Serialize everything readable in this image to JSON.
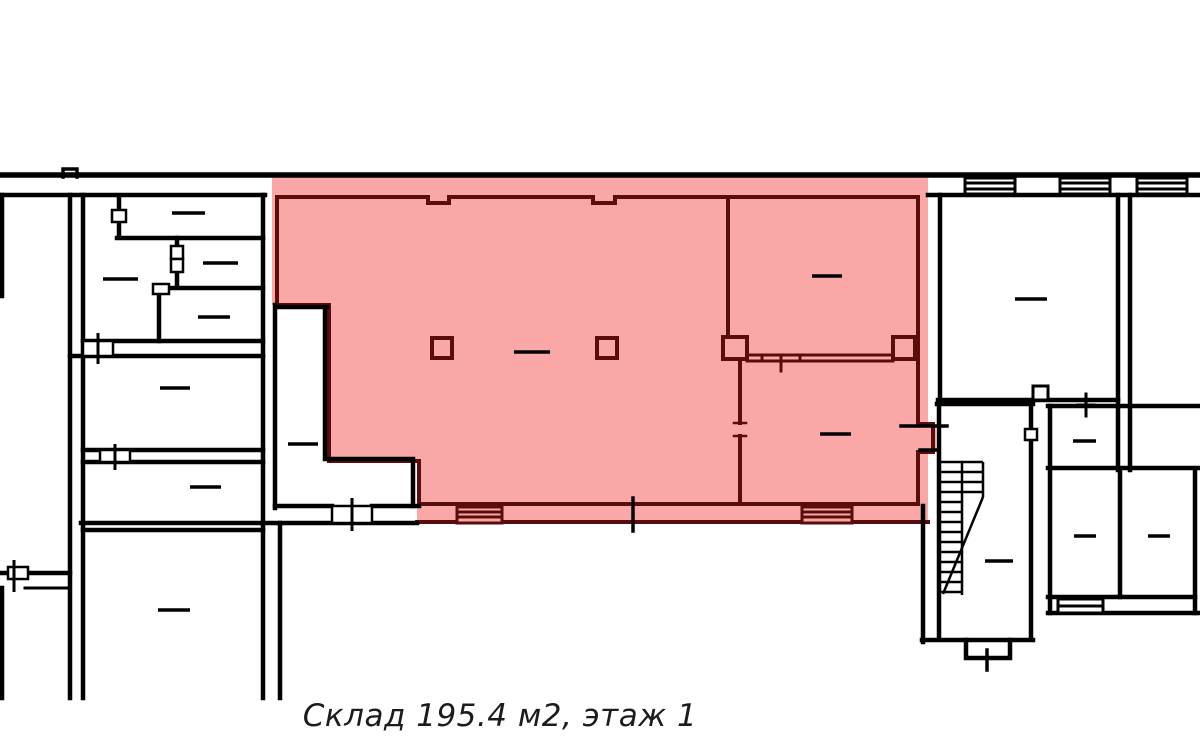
{
  "caption": {
    "text": "Склад 195.4 м2, этаж 1",
    "object_type": "Склад",
    "area_m2": "195.4",
    "floor": "1"
  },
  "colors": {
    "background": "#ffffff",
    "wall": "#000000",
    "highlight_fill": "#f9a7a7",
    "highlight_stroke": "#5a0d0d",
    "caption_color": "#1c1c1c"
  }
}
